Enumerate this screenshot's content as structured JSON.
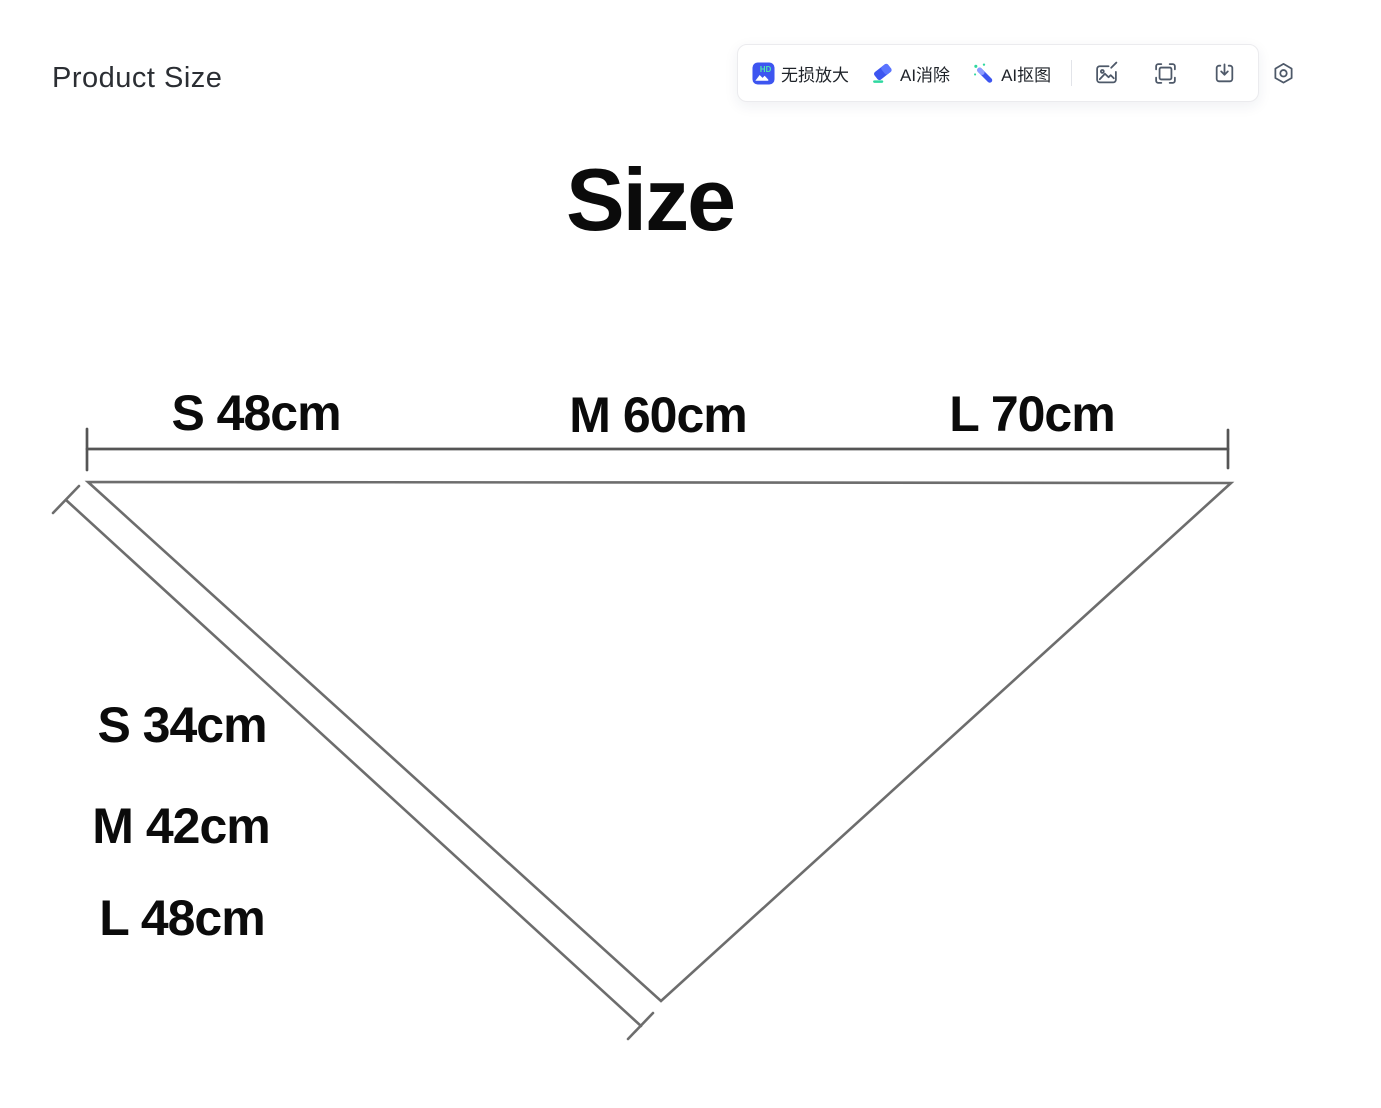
{
  "header": {
    "title": "Product Size"
  },
  "toolbar": {
    "buttons": [
      {
        "id": "hd-upscale",
        "label": "无损放大",
        "icon": "hd-upscale-icon"
      },
      {
        "id": "ai-erase",
        "label": "AI消除",
        "icon": "ai-eraser-icon"
      },
      {
        "id": "ai-cutout",
        "label": "AI抠图",
        "icon": "ai-magic-wand-icon"
      }
    ],
    "icon_buttons": [
      {
        "id": "edit-image",
        "icon": "image-edit-icon"
      },
      {
        "id": "screenshot",
        "icon": "frame-capture-icon"
      },
      {
        "id": "download",
        "icon": "download-icon"
      },
      {
        "id": "settings",
        "icon": "settings-hexagon-icon"
      }
    ],
    "colors": {
      "accent_blue": "#3D55F0",
      "accent_green": "#2FD8A0",
      "icon_gray": "#4E5969",
      "border": "#EBEBEE",
      "label_text": "#1F2329"
    }
  },
  "diagram": {
    "title": "Size",
    "top_measurements": [
      {
        "size": "S",
        "value_cm": 48,
        "label": "S 48cm"
      },
      {
        "size": "M",
        "value_cm": 60,
        "label": "M 60cm"
      },
      {
        "size": "L",
        "value_cm": 70,
        "label": "L 70cm"
      }
    ],
    "side_measurements": [
      {
        "size": "S",
        "value_cm": 34,
        "label": "S 34cm"
      },
      {
        "size": "M",
        "value_cm": 42,
        "label": "M 42cm"
      },
      {
        "size": "L",
        "value_cm": 48,
        "label": "L 48cm"
      }
    ],
    "line_color": "#6D6D6D",
    "text_color": "#0B0B0B"
  }
}
